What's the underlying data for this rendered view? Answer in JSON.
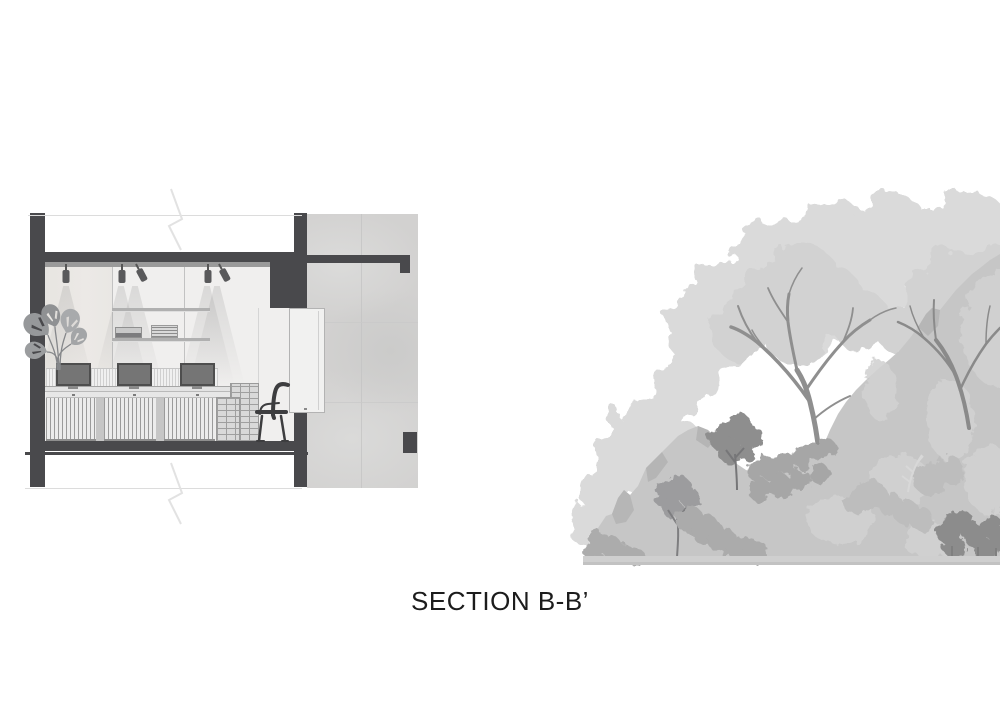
{
  "title": {
    "label": "SECTION B-B’"
  },
  "palette": {
    "structure_dark": "#49494c",
    "concrete_gray": "#d2d1d0",
    "ceiling_gray": "#9a9a9a",
    "interior_wall": "#f0efee",
    "hill_gray": "#c6c6c6",
    "tree_light_gray": "#dadada",
    "tree_mid_gray": "#d2d2d2",
    "vegetation_dark_gray": "#8e8e8e",
    "title_text": "#1c1c1c"
  }
}
